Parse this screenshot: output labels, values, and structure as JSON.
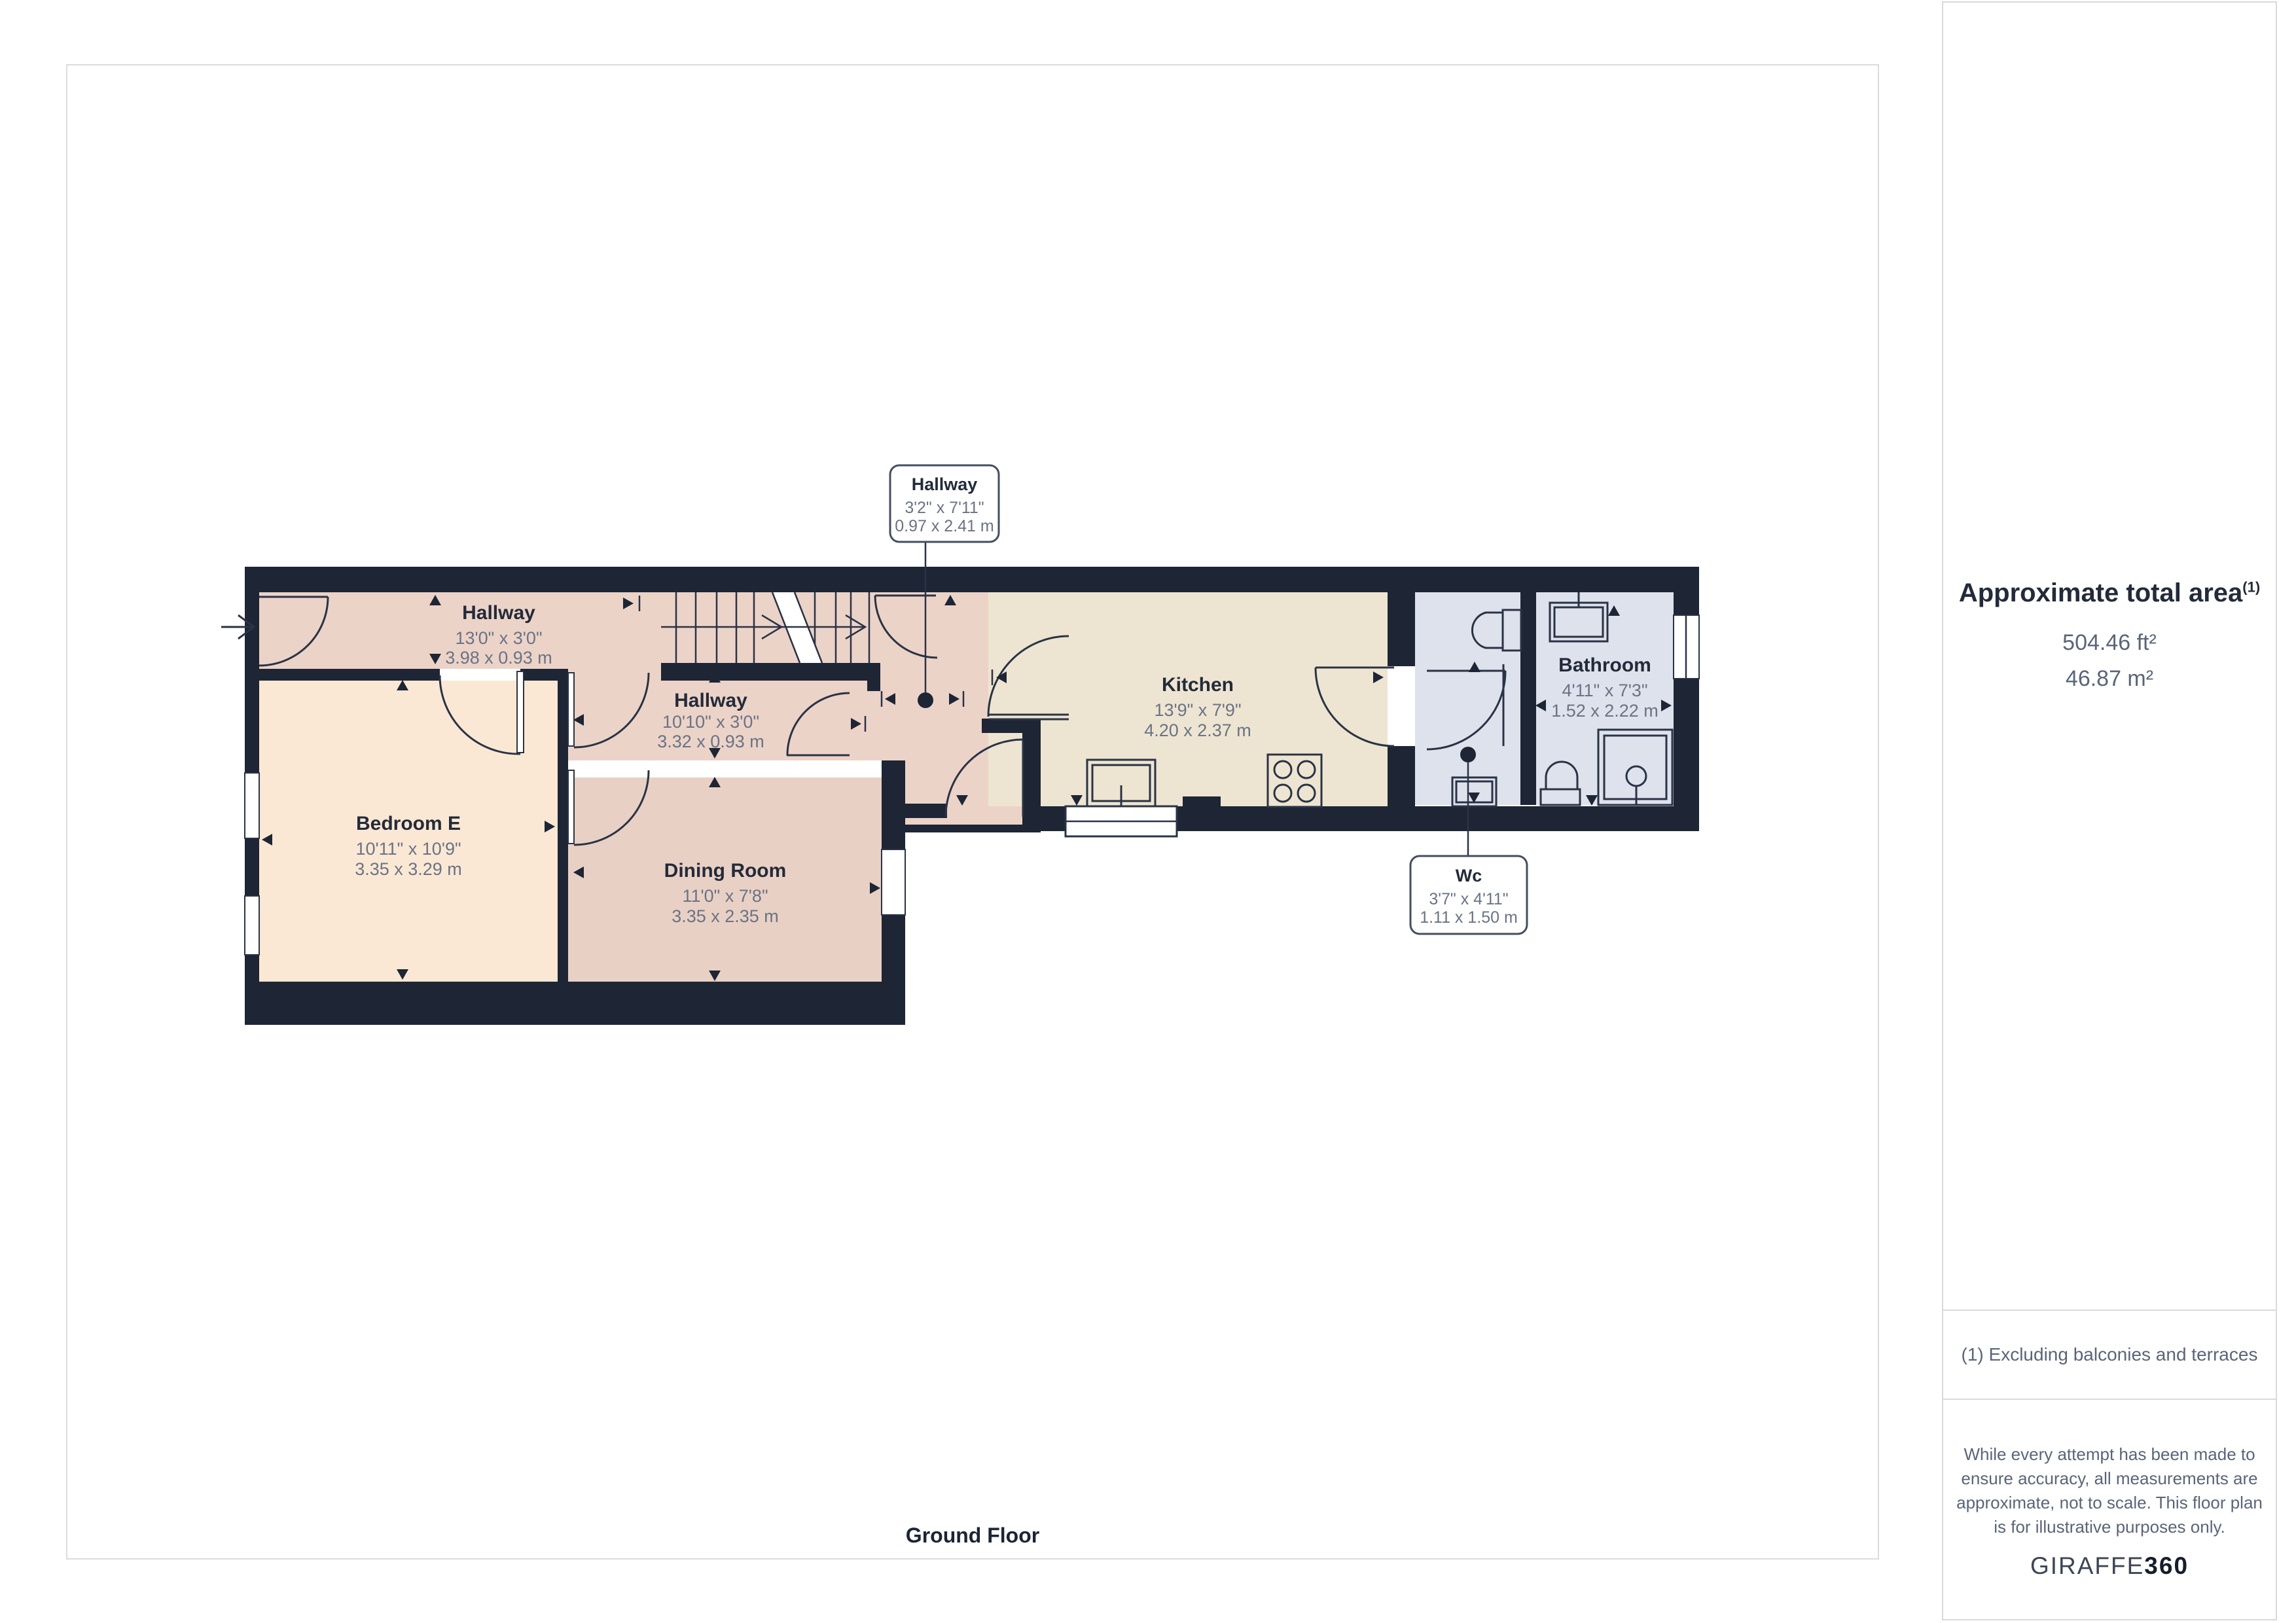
{
  "plan": {
    "floor_label": "Ground Floor"
  },
  "rooms": {
    "hallway_top": {
      "name": "Hallway",
      "imperial": "13'0\" x 3'0\"",
      "metric": "3.98 x 0.93 m"
    },
    "hallway_mid": {
      "name": "Hallway",
      "imperial": "10'10\" x 3'0\"",
      "metric": "3.32 x 0.93 m"
    },
    "bedroom_e": {
      "name": "Bedroom E",
      "imperial": "10'11\" x 10'9\"",
      "metric": "3.35 x 3.29 m"
    },
    "dining": {
      "name": "Dining Room",
      "imperial": "11'0\" x 7'8\"",
      "metric": "3.35 x 2.35 m"
    },
    "kitchen": {
      "name": "Kitchen",
      "imperial": "13'9\" x 7'9\"",
      "metric": "4.20 x 2.37 m"
    },
    "bathroom": {
      "name": "Bathroom",
      "imperial": "4'11\" x 7'3\"",
      "metric": "1.52 x 2.22 m"
    }
  },
  "callouts": {
    "hallway": {
      "name": "Hallway",
      "imperial": "3'2\" x 7'11\"",
      "metric": "0.97 x 2.41 m"
    },
    "wc": {
      "name": "Wc",
      "imperial": "3'7\" x 4'11\"",
      "metric": "1.11 x 1.50 m"
    }
  },
  "sidebar": {
    "area_title": "Approximate total area",
    "area_marker": "(1)",
    "area_ft": "504.46 ft²",
    "area_m": "46.87 m²",
    "footnote": "(1) Excluding balconies and terraces",
    "disclaimer": "While every attempt has been made to ensure accuracy, all measurements are approximate, not to scale. This floor plan is for illustrative purposes only.",
    "brand_name": "GIRAFFE",
    "brand_suffix": "360"
  },
  "colors": {
    "wall": "#1e2534",
    "hallway_fill": "#ecd3c8",
    "dining_fill": "#e9d0c5",
    "bedroom_fill": "#fbe8d4",
    "kitchen_fill": "#ede5d1",
    "bathroom_fill": "#dde2ec",
    "line": "#2a3345",
    "label_title": "#232b3a",
    "label_dims": "#6a7385",
    "border_gray": "#dcdcdc"
  }
}
